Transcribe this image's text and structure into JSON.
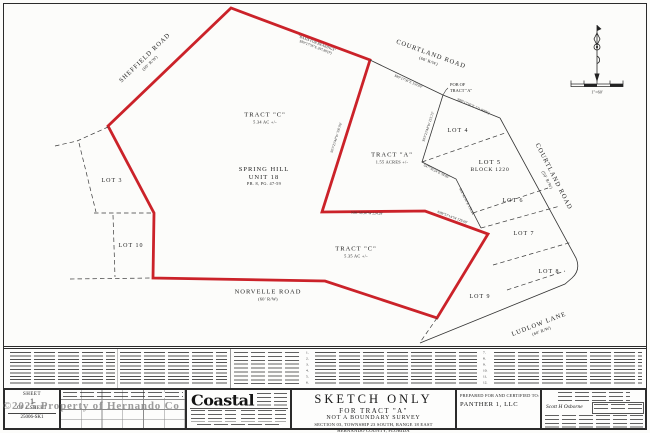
{
  "colors": {
    "boundary_red": "#cb2229",
    "ink": "#1c1c1c",
    "watermark_gray": "#838383"
  },
  "plan": {
    "roads": {
      "sheffield": {
        "name": "SHEFFIELD ROAD",
        "rw": "(60' R/W)"
      },
      "courtland60": {
        "name": "COURTLAND ROAD",
        "rw": "(60' R/W)"
      },
      "courtland50": {
        "name": "COURTLAND ROAD",
        "rw": "(50' R/W)"
      },
      "norvelle": {
        "name": "NORVELLE ROAD",
        "rw": "(60' R/W)"
      },
      "ludlow": {
        "name": "LUDLOW LANE",
        "rw": "(60' R/W)"
      }
    },
    "tracts": {
      "c_north": {
        "name": "TRACT \"C\"",
        "area": "5.34 AC +/-"
      },
      "a": {
        "name": "TRACT \"A\"",
        "area": "1.55 ACRES +/-"
      },
      "c_south": {
        "name": "TRACT \"C\"",
        "area": "5.35 AC +/-"
      }
    },
    "subdivision": {
      "line1": "SPRING HILL",
      "line2": "UNIT 18",
      "line3": "PB. 8, PG. 47-59"
    },
    "lots": {
      "lot3": "LOT 3",
      "lot4": "LOT 4",
      "lot5": "LOT 5",
      "lot5_block": "BLOCK 1220",
      "lot6": "LOT 6",
      "lot7": "LOT 7",
      "lot8": "LOT 8",
      "lot9": "LOT 9",
      "lot10": "LOT 10"
    },
    "pob": {
      "line1": "POB OF",
      "line2": "TRACT \"A\""
    },
    "bearings": {
      "basis_line1": "\"BASIS FOR BEARINGS\"",
      "basis_line2": "S89°17'56\"E 297.80'(P)",
      "courtland_w": "S89°17'56\"E 150.00'",
      "courtland_e": "S89°17'56\"E 121.00'(D)",
      "west_long": "S03°23'44\"W 350.96'",
      "tract_a_east": "S03°23'44\"W 153.73'",
      "se_short": "S47°36'24\"E 59.05'",
      "lot_line": "S02°42'30\"E 158.44'",
      "south_long": "N89°56'34\"W 224.29'",
      "south_diag": "N89°57'14\"W 129.69'"
    },
    "scale_label": "1\"=60'"
  },
  "notes": {
    "col1_numbers": [
      "1.",
      "2.",
      "3.",
      "4.",
      "5.",
      "6."
    ],
    "col2_numbers": [
      "7.",
      "8.",
      "9.",
      "10.",
      "11.",
      "12."
    ]
  },
  "title_block": {
    "title": "SKETCH ONLY",
    "for_line": "FOR TRACT \"A\"",
    "type_line": "NOT A BOUNDARY SURVEY",
    "section_line": "SECTION 03, TOWNSHIP 23 SOUTH, RANGE 18 EAST",
    "county_line": "HERNANDO COUNTY, FLORIDA"
  },
  "prepared_for": {
    "heading": "PREPARED FOR AND CERTIFIED TO:",
    "client": "PANTHER 1, LLC"
  },
  "firm": {
    "logo_text": "Coastal"
  },
  "certificate": {
    "surveyor_name": "Scott H Osborne"
  },
  "sheet_box": {
    "label": "SHEET",
    "number": "1",
    "of_line": "OF 1 SHEET",
    "file_no": "25006-SK1"
  },
  "watermark": "©2025 Property of Hernando Co"
}
